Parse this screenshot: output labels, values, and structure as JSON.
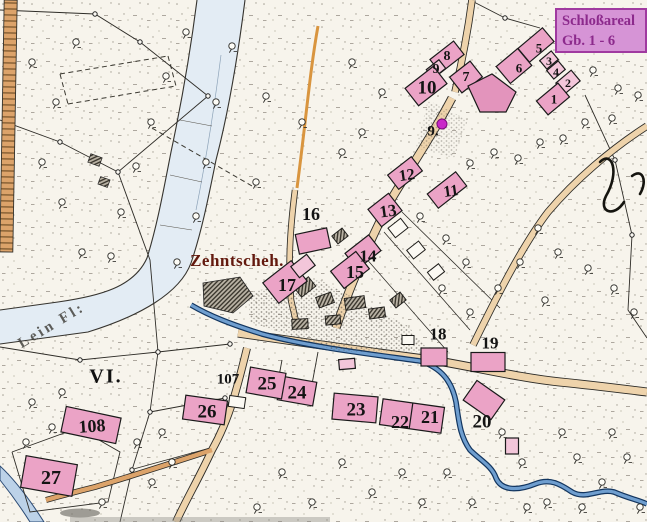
{
  "legend_box": {
    "title": "Schloßareal",
    "subtitle": "Gb. 1 - 6"
  },
  "place_labels": {
    "tithe_barn": "Zehntscheh.",
    "river": "Lein Fl:",
    "district": "VI."
  },
  "building_numbers": {
    "b1": "1",
    "b2": "2",
    "b3": "3",
    "b4": "4",
    "b5": "5",
    "b6": "6",
    "b7": "7",
    "b8": "8",
    "b9": "9",
    "b9b": "9.",
    "b10": "10",
    "b11": "11",
    "b12": "12",
    "b13": "13",
    "b14": "14",
    "b15": "15",
    "b16": "16",
    "b17": "17",
    "b18": "18",
    "b19": "19",
    "b20": "20",
    "b21": "21",
    "b22": "22",
    "b23": "23",
    "b24": "24",
    "b25": "25",
    "b26": "26",
    "b27": "27",
    "b107": "107",
    "b108": "108"
  },
  "colors": {
    "paper": "#f7f4ec",
    "highlight_pink": "#eba3c6",
    "highlight_pink_light": "#f3c6da",
    "legend_purple_bg": "#d694d6",
    "legend_purple_text": "#8c2a8c",
    "river_blue": "#e3ecf4",
    "stream_blue": "#6f9ecf",
    "road_tan": "#eed3ab",
    "path_orange": "#d9953f",
    "marker_magenta": "#c928c9",
    "label_black": "#141414",
    "label_darkred": "#63190e"
  }
}
